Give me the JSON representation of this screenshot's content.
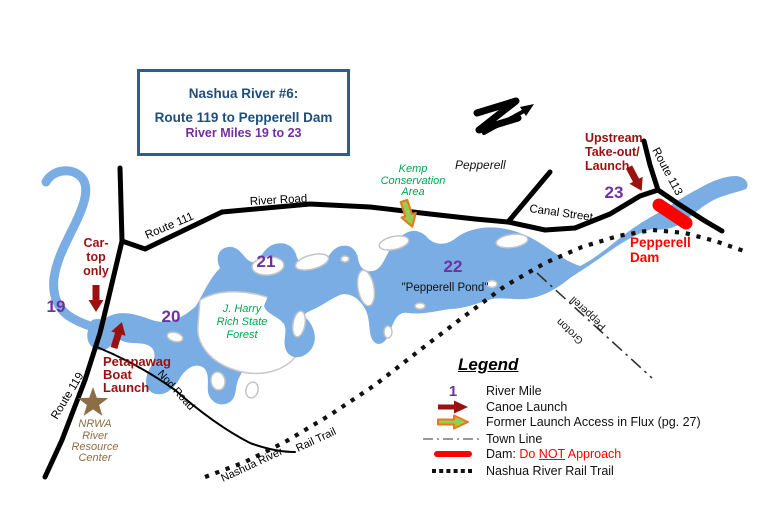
{
  "title_box": {
    "line1": "Nashua River #6:",
    "line2": "Route 119 to Pepperell Dam",
    "line3": "River Miles 19 to 23"
  },
  "map": {
    "town_label": "Pepperell",
    "roads": {
      "route_111": "Route 111",
      "river_road": "River Road",
      "route_119": "Route 119",
      "nod_road": "Nod Road",
      "canal_street": "Canal Street",
      "route_113": "Route 113"
    },
    "river_miles": {
      "m19": "19",
      "m20": "20",
      "m21": "21",
      "m22": "22",
      "m23": "23"
    },
    "areas": {
      "kemp": {
        "l1": "Kemp",
        "l2": "Conservation",
        "l3": "Area"
      },
      "jharry": {
        "l1": "J. Harry",
        "l2": "Rich State",
        "l3": "Forest"
      },
      "pond": "\"Pepperell Pond\""
    },
    "launches": {
      "car_top": {
        "l1": "Car-",
        "l2": "top",
        "l3": "only"
      },
      "petapawag": {
        "l1": "Petapawag",
        "l2": "Boat",
        "l3": "Launch"
      },
      "upstream": {
        "l1": "Upstream",
        "l2": "Take-out/",
        "l3": "Launch"
      }
    },
    "dam": {
      "l1": "Pepperell",
      "l2": "Dam"
    },
    "nrwa": {
      "l1": "NRWA",
      "l2": "River",
      "l3": "Resource",
      "l4": "Center"
    },
    "rail_trail": {
      "part1": "Nashua River",
      "part2": "Rail Trail"
    },
    "town_line": {
      "north": "Pepperell",
      "south": "Groton"
    }
  },
  "legend": {
    "title": "Legend",
    "river_mile": {
      "symbol": "1",
      "label": "River Mile"
    },
    "canoe_launch": {
      "label": "Canoe Launch"
    },
    "flux": {
      "label": "Former Launch Access in Flux (pg. 27)"
    },
    "town_line": {
      "label": "Town Line"
    },
    "dam": {
      "prefix": "Dam: ",
      "warn_pre": "Do ",
      "warn_not": "NOT",
      "warn_post": " Approach"
    },
    "rail_trail": {
      "label": "Nashua River Rail Trail"
    }
  },
  "colors": {
    "river_blue": "#79ade3",
    "title_blue": "#1f4e79",
    "mile_purple": "#7030a0",
    "launch_dark_red": "#991111",
    "dam_red": "#ff0000",
    "forest_green": "#00a550",
    "nrwa_brown": "#8c6d46",
    "flux_orange": "#e87722",
    "flux_green": "#92d050"
  }
}
